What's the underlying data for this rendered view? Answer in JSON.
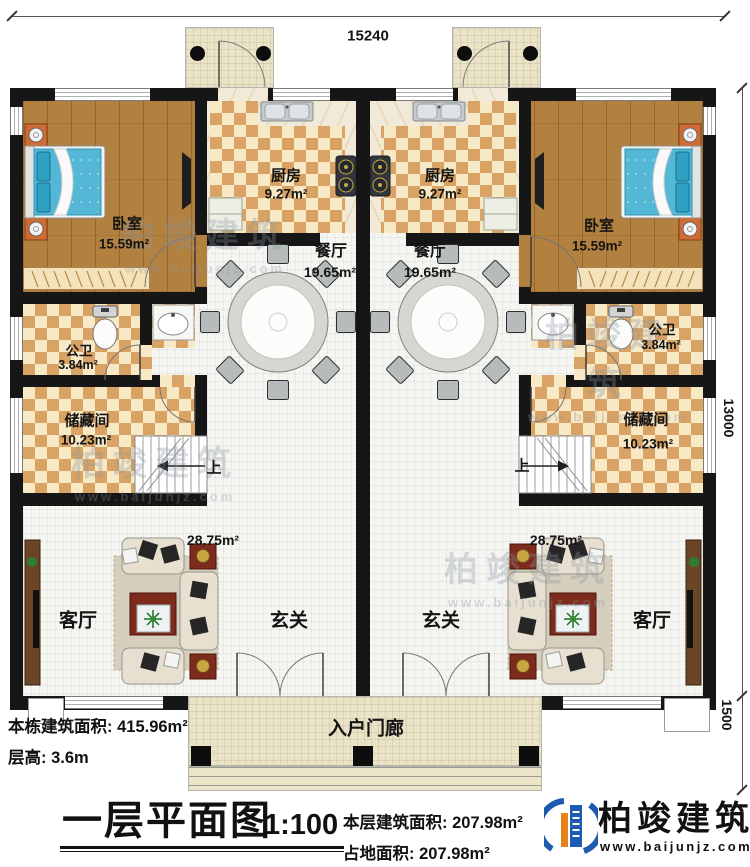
{
  "dimensions": {
    "width_top": "15240",
    "height_right": "13000",
    "porch_depth": "1500"
  },
  "rooms": {
    "bedroom_left": {
      "name": "卧室",
      "area": "15.59m²"
    },
    "bedroom_right": {
      "name": "卧室",
      "area": "15.59m²"
    },
    "kitchen_left": {
      "name": "厨房",
      "area": "9.27m²"
    },
    "kitchen_right": {
      "name": "厨房",
      "area": "9.27m²"
    },
    "dining_left": {
      "name": "餐厅",
      "area": "19.65m²"
    },
    "dining_right": {
      "name": "餐厅",
      "area": "19.65m²"
    },
    "bath_left": {
      "name": "公卫",
      "area": "3.84m²"
    },
    "bath_right": {
      "name": "公卫",
      "area": "3.84m²"
    },
    "storage_left": {
      "name": "储藏间",
      "area": "10.23m²"
    },
    "storage_right": {
      "name": "储藏间",
      "area": "10.23m²"
    },
    "living_left": {
      "name": "客厅",
      "area": "28.75m²"
    },
    "living_right": {
      "name": "客厅",
      "area": "28.75m²"
    },
    "foyer_left": {
      "name": "玄关"
    },
    "foyer_right": {
      "name": "玄关"
    },
    "porch": {
      "name": "入户门廊"
    },
    "stair_up_left": "上",
    "stair_up_right": "上"
  },
  "info": {
    "building_area_label": "本栋建筑面积: ",
    "building_area_value": "415.96m²",
    "floor_height_label": "层高: ",
    "floor_height_value": "3.6m"
  },
  "titleblock": {
    "title": "一层平面图",
    "scale": "1:100",
    "floor_area_label": "本层建筑面积: ",
    "floor_area_value": "207.98m²",
    "land_area_label": "占地面积: ",
    "land_area_value": "207.98m²"
  },
  "logo": {
    "name": "柏竣建筑",
    "website": "www.baijunjz.com"
  },
  "watermark": {
    "text": "柏竣建筑",
    "website": "www.baijunjz.com"
  },
  "colors": {
    "wall": "#161616",
    "checker": "#d8a364",
    "wood": "#b2803f",
    "bed": "#54b7d6",
    "logo_blue": "#1d5bb0",
    "logo_orange": "#e8821c"
  }
}
